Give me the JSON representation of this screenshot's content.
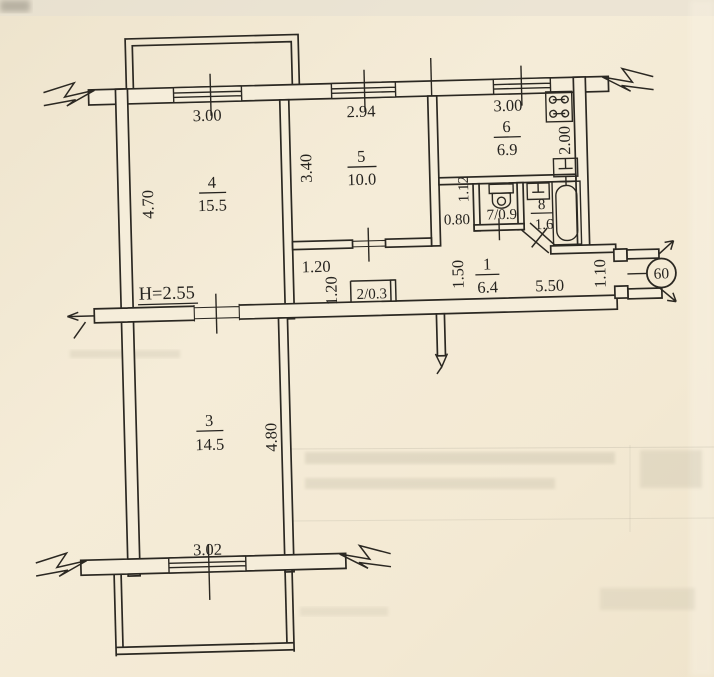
{
  "plan": {
    "ceiling_height": "H=2.55",
    "apartment_number": "60",
    "rooms": {
      "r1": {
        "number": "1",
        "area": "6.4"
      },
      "r2": {
        "label": "2/0.3"
      },
      "r3": {
        "number": "3",
        "area": "14.5"
      },
      "r4": {
        "number": "4",
        "area": "15.5"
      },
      "r5": {
        "number": "5",
        "area": "10.0"
      },
      "r6": {
        "number": "6",
        "area": "6.9"
      },
      "r7": {
        "label": "7/0.9"
      },
      "r8": {
        "number": "8",
        "area": "1.6"
      }
    },
    "dimensions": {
      "r4_width": "3.00",
      "r4_depth": "4.70",
      "r5_width": "2.94",
      "r5_depth": "3.40",
      "r6_width": "3.00",
      "r6_depth": "2.00",
      "wc_niche_depth": "1.12",
      "wc_niche_width": "0.80",
      "hall_width": "1.50",
      "hall_length": "5.50",
      "entry_door_width": "1.10",
      "closet_width": "1.20",
      "closet_depth": "1.20",
      "r3_width": "3.02",
      "r3_depth": "4.80"
    },
    "icons": [
      "stove-icon",
      "kitchen-sink-icon",
      "toilet-icon",
      "bath-sink-icon",
      "bathtub-icon"
    ]
  }
}
